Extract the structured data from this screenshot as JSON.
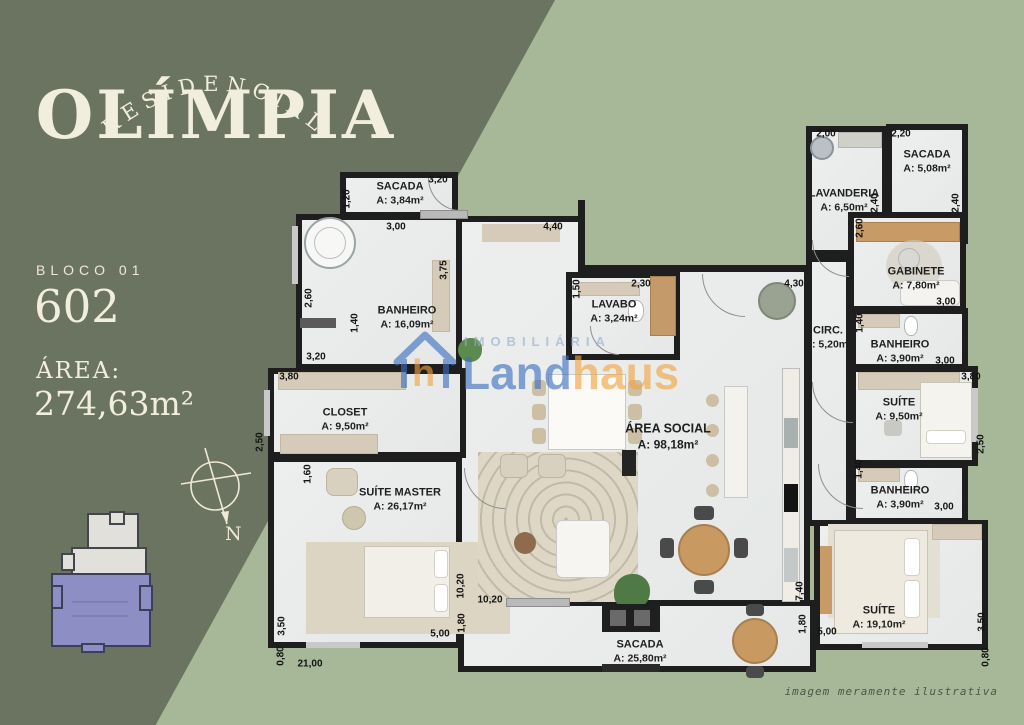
{
  "brand": {
    "pre_title": "RESIDENCIAL",
    "title": "OLÍMPIA"
  },
  "unit": {
    "block_label": "BLOCO 01",
    "number": "602",
    "area_label": "ÁREA:",
    "area_value": "274,63m²"
  },
  "compass": {
    "label": "N"
  },
  "watermark": {
    "imobiliaria": "IMOBILIÁRIA",
    "land": "Land",
    "haus": "haus",
    "blue": "#3A6EC0",
    "orange": "#F2A440"
  },
  "disclaimer": "imagem meramente ilustrativa",
  "colors": {
    "dark_green": "#6B7460",
    "light_green": "#A7B899",
    "cream": "#F2EEDE",
    "wall": "#1E1E1E",
    "floor": "#EBEDEC",
    "highlight_purple": "#8D8FC4"
  },
  "plan": {
    "rooms": [
      {
        "id": "sacada-superior",
        "name": "SACADA",
        "area": "A: 3,84m²",
        "box": [
          340,
          172,
          118,
          46
        ],
        "label": [
          400,
          194
        ]
      },
      {
        "id": "banheiro-master",
        "name": "BANHEIRO",
        "area": "A: 16,09m²",
        "box": [
          296,
          214,
          166,
          156
        ],
        "label": [
          407,
          318
        ]
      },
      {
        "id": "area-social",
        "name": "ÁREA SOCIAL",
        "area": "A: 98,18m²",
        "box": [
          456,
          216,
          354,
          390
        ],
        "label": [
          668,
          437
        ],
        "big": true
      },
      {
        "id": "closet",
        "name": "CLOSET",
        "area": "A: 9,50m²",
        "box": [
          268,
          368,
          198,
          90
        ],
        "label": [
          345,
          420
        ]
      },
      {
        "id": "suite-master",
        "name": "SUÍTE MASTER",
        "area": "A: 26,17m²",
        "box": [
          268,
          456,
          194,
          192
        ],
        "label": [
          400,
          500
        ]
      },
      {
        "id": "lavabo",
        "name": "LAVABO",
        "area": "A: 3,24m²",
        "box": [
          566,
          272,
          114,
          88
        ],
        "label": [
          614,
          312
        ]
      },
      {
        "id": "sacada-inferior",
        "name": "SACADA",
        "area": "A: 25,80m²",
        "box": [
          458,
          600,
          358,
          72
        ],
        "label": [
          640,
          652
        ]
      },
      {
        "id": "lavanderia",
        "name": "LAVANDERIA",
        "area": "A: 6,50m²",
        "box": [
          806,
          126,
          82,
          130
        ],
        "label": [
          844,
          201
        ]
      },
      {
        "id": "sacada-servico",
        "name": "SACADA",
        "area": "A: 5,08m²",
        "box": [
          886,
          124,
          82,
          120
        ],
        "label": [
          927,
          162
        ]
      },
      {
        "id": "gabinete",
        "name": "GABINETE",
        "area": "A: 7,80m²",
        "box": [
          848,
          212,
          118,
          100
        ],
        "label": [
          916,
          279
        ]
      },
      {
        "id": "circulacao",
        "name": "CIRC.",
        "area": "A: 5,20m²",
        "box": [
          806,
          256,
          46,
          270
        ],
        "label": [
          828,
          338
        ]
      },
      {
        "id": "banheiro-suite-1",
        "name": "BANHEIRO",
        "area": "A: 3,90m²",
        "box": [
          850,
          308,
          118,
          62
        ],
        "label": [
          900,
          352
        ]
      },
      {
        "id": "suite-1",
        "name": "SUÍTE",
        "area": "A: 9,50m²",
        "box": [
          850,
          366,
          128,
          100
        ],
        "label": [
          899,
          410
        ]
      },
      {
        "id": "banheiro-suite-2",
        "name": "BANHEIRO",
        "area": "A: 3,90m²",
        "box": [
          850,
          462,
          118,
          62
        ],
        "label": [
          900,
          498
        ]
      },
      {
        "id": "suite-2",
        "name": "SUÍTE",
        "area": "A: 19,10m²",
        "box": [
          814,
          520,
          174,
          130
        ],
        "label": [
          879,
          618
        ]
      }
    ],
    "dims": [
      {
        "t": "3,20",
        "x": 438,
        "y": 180
      },
      {
        "t": "1,20",
        "x": 347,
        "y": 199,
        "v": 1
      },
      {
        "t": "3,00",
        "x": 396,
        "y": 227
      },
      {
        "t": "4,40",
        "x": 553,
        "y": 227
      },
      {
        "t": "3,75",
        "x": 444,
        "y": 270,
        "v": 1
      },
      {
        "t": "2,60",
        "x": 309,
        "y": 298,
        "v": 1
      },
      {
        "t": "1,40",
        "x": 355,
        "y": 323,
        "v": 1
      },
      {
        "t": "3,20",
        "x": 316,
        "y": 357
      },
      {
        "t": "3,80",
        "x": 289,
        "y": 377
      },
      {
        "t": "2,50",
        "x": 260,
        "y": 442,
        "v": 1
      },
      {
        "t": "1,60",
        "x": 308,
        "y": 474,
        "v": 1
      },
      {
        "t": "3,50",
        "x": 282,
        "y": 626,
        "v": 1
      },
      {
        "t": "0,80",
        "x": 281,
        "y": 656,
        "v": 1
      },
      {
        "t": "21,00",
        "x": 310,
        "y": 664
      },
      {
        "t": "5,00",
        "x": 440,
        "y": 634
      },
      {
        "t": "10,20",
        "x": 461,
        "y": 586,
        "v": 1
      },
      {
        "t": "1,80",
        "x": 462,
        "y": 623,
        "v": 1
      },
      {
        "t": "10,20",
        "x": 490,
        "y": 600
      },
      {
        "t": "1,50",
        "x": 577,
        "y": 289,
        "v": 1
      },
      {
        "t": "2,30",
        "x": 641,
        "y": 284
      },
      {
        "t": "4,30",
        "x": 794,
        "y": 284
      },
      {
        "t": "2,00",
        "x": 826,
        "y": 134
      },
      {
        "t": "2,20",
        "x": 901,
        "y": 134
      },
      {
        "t": "2,40",
        "x": 875,
        "y": 203,
        "v": 1
      },
      {
        "t": "2,40",
        "x": 956,
        "y": 203,
        "v": 1
      },
      {
        "t": "2,60",
        "x": 860,
        "y": 228,
        "v": 1
      },
      {
        "t": "3,00",
        "x": 946,
        "y": 302
      },
      {
        "t": "1,40",
        "x": 860,
        "y": 323,
        "v": 1
      },
      {
        "t": "3,00",
        "x": 945,
        "y": 361
      },
      {
        "t": "3,80",
        "x": 971,
        "y": 377
      },
      {
        "t": "2,50",
        "x": 981,
        "y": 444,
        "v": 1
      },
      {
        "t": "1,40",
        "x": 859,
        "y": 469,
        "v": 1
      },
      {
        "t": "3,00",
        "x": 944,
        "y": 507
      },
      {
        "t": "7,40",
        "x": 800,
        "y": 591,
        "v": 1
      },
      {
        "t": "1,80",
        "x": 803,
        "y": 624,
        "v": 1
      },
      {
        "t": "5,00",
        "x": 827,
        "y": 632
      },
      {
        "t": "3,50",
        "x": 982,
        "y": 622,
        "v": 1
      },
      {
        "t": "0,80",
        "x": 986,
        "y": 657,
        "v": 1
      }
    ]
  }
}
